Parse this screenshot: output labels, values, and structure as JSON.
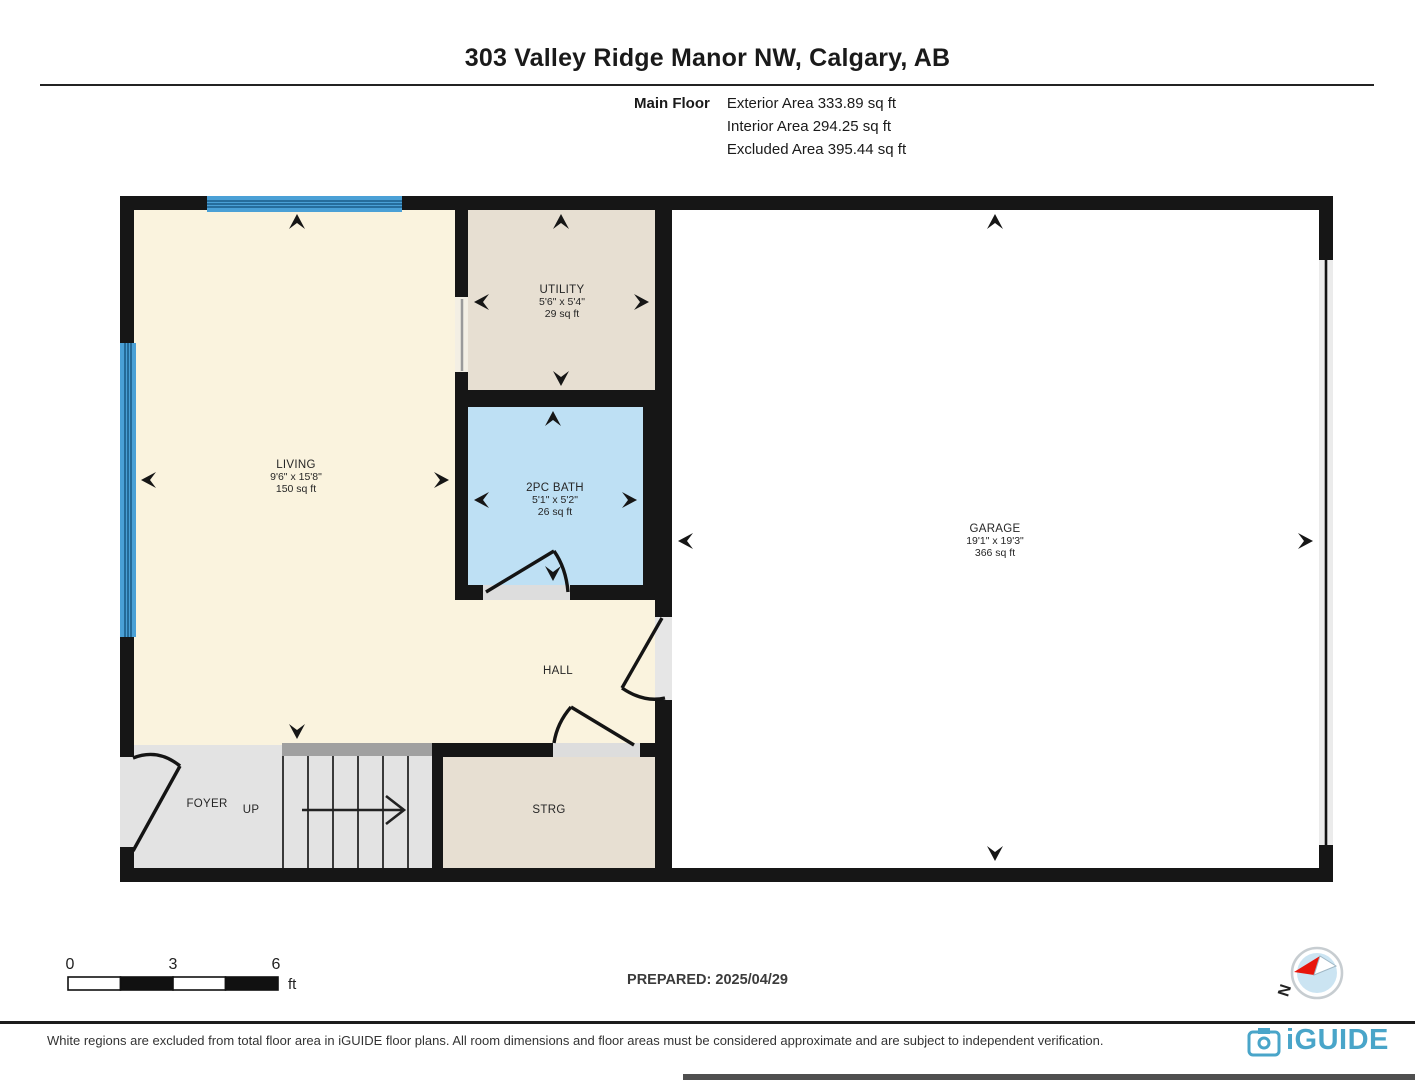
{
  "header": {
    "title": "303 Valley Ridge Manor NW, Calgary, AB",
    "floor_label": "Main Floor",
    "stats": [
      "Exterior Area 333.89 sq ft",
      "Interior Area 294.25 sq ft",
      "Excluded Area 395.44 sq ft"
    ]
  },
  "rooms": {
    "living": {
      "name": "LIVING",
      "dims": "9'6\" x 15'8\"",
      "area": "150 sq ft"
    },
    "utility": {
      "name": "UTILITY",
      "dims": "5'6\" x 5'4\"",
      "area": "29 sq ft"
    },
    "bath": {
      "name": "2PC BATH",
      "dims": "5'1\" x 5'2\"",
      "area": "26 sq ft"
    },
    "garage": {
      "name": "GARAGE",
      "dims": "19'1\" x 19'3\"",
      "area": "366 sq ft"
    },
    "hall": {
      "name": "HALL"
    },
    "foyer": {
      "name": "FOYER"
    },
    "stairs": {
      "name": "UP"
    },
    "storage": {
      "name": "STRG"
    }
  },
  "scale_bar": {
    "ticks": [
      "0",
      "3",
      "6"
    ],
    "unit": "ft"
  },
  "compass": {
    "north_label": "N"
  },
  "footer": {
    "prepared": "PREPARED: 2025/04/29",
    "disclaimer": "White regions are excluded from total floor area in iGUIDE floor plans. All room dimensions and floor areas must be considered approximate and are subject to independent verification.",
    "brand": "iGUIDE"
  },
  "colors": {
    "wall": "#161616",
    "interior_cream": "#FAF3DE",
    "excluded_beige": "#E7DFD2",
    "bath_blue": "#BEE0F4",
    "excluded_gray": "#E3E3E3",
    "stair_nosing_gray": "#A0A0A0",
    "window_blue": "#4AA0D6",
    "garage_white": "#FFFFFF",
    "brand_blue": "#49A5C9",
    "compass_red": "#E8150B"
  }
}
